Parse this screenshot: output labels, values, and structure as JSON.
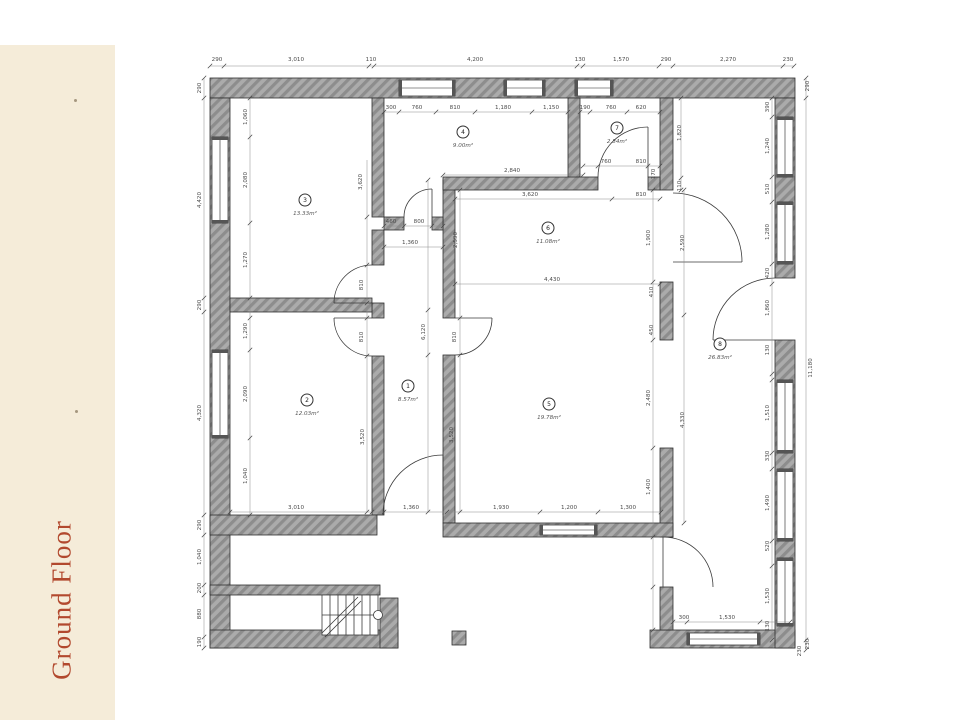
{
  "sidebar": {
    "title": "Ground Floor",
    "bg": "#f5ecd9",
    "text_color": "#b2492e"
  },
  "plan": {
    "wall_fill": "#ababab",
    "wall_hatch": "#8d8d8d",
    "line_color": "#3a3a3a",
    "dim_color": "#4a4a4a",
    "rooms": [
      {
        "number": "1",
        "area": "8.57m²",
        "x": 408,
        "y": 386
      },
      {
        "number": "2",
        "area": "12.03m²",
        "x": 307,
        "y": 400
      },
      {
        "number": "3",
        "area": "13.33m²",
        "x": 305,
        "y": 200
      },
      {
        "number": "4",
        "area": "9.00m²",
        "x": 463,
        "y": 132
      },
      {
        "number": "5",
        "area": "19.78m²",
        "x": 549,
        "y": 404
      },
      {
        "number": "6",
        "area": "11.08m²",
        "x": 548,
        "y": 228
      },
      {
        "number": "7",
        "area": "2.84m²",
        "x": 617,
        "y": 128
      },
      {
        "number": "8",
        "area": "26.83m²",
        "x": 720,
        "y": 344
      }
    ],
    "dimensions": [
      {
        "t": "290",
        "x": 217,
        "y": 61
      },
      {
        "t": "3,010",
        "x": 296,
        "y": 61
      },
      {
        "t": "110",
        "x": 371,
        "y": 61
      },
      {
        "t": "4,200",
        "x": 475,
        "y": 61
      },
      {
        "t": "130",
        "x": 580,
        "y": 61
      },
      {
        "t": "1,570",
        "x": 621,
        "y": 61
      },
      {
        "t": "290",
        "x": 666,
        "y": 61
      },
      {
        "t": "2,270",
        "x": 728,
        "y": 61
      },
      {
        "t": "230",
        "x": 788,
        "y": 61
      },
      {
        "t": "300",
        "x": 391,
        "y": 109
      },
      {
        "t": "760",
        "x": 417,
        "y": 109
      },
      {
        "t": "810",
        "x": 455,
        "y": 109
      },
      {
        "t": "1,180",
        "x": 503,
        "y": 109
      },
      {
        "t": "1,150",
        "x": 551,
        "y": 109
      },
      {
        "t": "190",
        "x": 585,
        "y": 109
      },
      {
        "t": "760",
        "x": 611,
        "y": 109
      },
      {
        "t": "620",
        "x": 641,
        "y": 109
      },
      {
        "t": "760",
        "x": 606,
        "y": 163
      },
      {
        "t": "810",
        "x": 641,
        "y": 163
      },
      {
        "t": "2,840",
        "x": 512,
        "y": 172
      },
      {
        "t": "3,620",
        "x": 530,
        "y": 196
      },
      {
        "t": "810",
        "x": 641,
        "y": 196
      },
      {
        "t": "4,430",
        "x": 552,
        "y": 281
      },
      {
        "t": "1,360",
        "x": 410,
        "y": 244
      },
      {
        "t": "460",
        "x": 391,
        "y": 223
      },
      {
        "t": "800",
        "x": 419,
        "y": 223
      },
      {
        "t": "3,010",
        "x": 296,
        "y": 509
      },
      {
        "t": "1,360",
        "x": 411,
        "y": 509
      },
      {
        "t": "1,930",
        "x": 501,
        "y": 509
      },
      {
        "t": "1,200",
        "x": 569,
        "y": 509
      },
      {
        "t": "1,300",
        "x": 628,
        "y": 509
      },
      {
        "t": "300",
        "x": 684,
        "y": 619
      },
      {
        "t": "1,530",
        "x": 727,
        "y": 619
      },
      {
        "t": "290",
        "x": 201,
        "y": 88,
        "r": 1
      },
      {
        "t": "4,420",
        "x": 201,
        "y": 200,
        "r": 1
      },
      {
        "t": "290",
        "x": 201,
        "y": 305,
        "r": 1
      },
      {
        "t": "4,320",
        "x": 201,
        "y": 413,
        "r": 1
      },
      {
        "t": "290",
        "x": 201,
        "y": 525,
        "r": 1
      },
      {
        "t": "1,040",
        "x": 201,
        "y": 557,
        "r": 1
      },
      {
        "t": "200",
        "x": 201,
        "y": 588,
        "r": 1
      },
      {
        "t": "880",
        "x": 201,
        "y": 614,
        "r": 1
      },
      {
        "t": "190",
        "x": 201,
        "y": 642,
        "r": 1
      },
      {
        "t": "1,060",
        "x": 247,
        "y": 117,
        "r": 1
      },
      {
        "t": "2,080",
        "x": 247,
        "y": 180,
        "r": 1
      },
      {
        "t": "1,270",
        "x": 247,
        "y": 260,
        "r": 1
      },
      {
        "t": "1,290",
        "x": 247,
        "y": 331,
        "r": 1
      },
      {
        "t": "2,090",
        "x": 247,
        "y": 394,
        "r": 1
      },
      {
        "t": "1,040",
        "x": 247,
        "y": 476,
        "r": 1
      },
      {
        "t": "3,620",
        "x": 362,
        "y": 182,
        "r": 1
      },
      {
        "t": "810",
        "x": 363,
        "y": 285,
        "r": 1
      },
      {
        "t": "810",
        "x": 363,
        "y": 337,
        "r": 1
      },
      {
        "t": "3,520",
        "x": 364,
        "y": 437,
        "r": 1
      },
      {
        "t": "6,120",
        "x": 425,
        "y": 332,
        "r": 1
      },
      {
        "t": "810",
        "x": 456,
        "y": 337,
        "r": 1
      },
      {
        "t": "2,590",
        "x": 457,
        "y": 240,
        "r": 1
      },
      {
        "t": "3,520",
        "x": 453,
        "y": 435,
        "r": 1
      },
      {
        "t": "170",
        "x": 655,
        "y": 174,
        "r": 1
      },
      {
        "t": "1,900",
        "x": 650,
        "y": 238,
        "r": 1
      },
      {
        "t": "410",
        "x": 653,
        "y": 292,
        "r": 1
      },
      {
        "t": "450",
        "x": 653,
        "y": 330,
        "r": 1
      },
      {
        "t": "2,480",
        "x": 650,
        "y": 398,
        "r": 1
      },
      {
        "t": "1,400",
        "x": 650,
        "y": 487,
        "r": 1
      },
      {
        "t": "1,820",
        "x": 681,
        "y": 133,
        "r": 1
      },
      {
        "t": "110",
        "x": 681,
        "y": 186,
        "r": 1
      },
      {
        "t": "2,590",
        "x": 684,
        "y": 243,
        "r": 1
      },
      {
        "t": "4,330",
        "x": 684,
        "y": 420,
        "r": 1
      },
      {
        "t": "290",
        "x": 809,
        "y": 86,
        "r": 1
      },
      {
        "t": "11,180",
        "x": 812,
        "y": 368,
        "r": 1
      },
      {
        "t": "230",
        "x": 809,
        "y": 644,
        "r": 1
      },
      {
        "t": "230",
        "x": 801,
        "y": 651,
        "r": 1
      },
      {
        "t": "390",
        "x": 769,
        "y": 107,
        "r": 1
      },
      {
        "t": "1,240",
        "x": 769,
        "y": 146,
        "r": 1
      },
      {
        "t": "510",
        "x": 769,
        "y": 189,
        "r": 1
      },
      {
        "t": "1,280",
        "x": 769,
        "y": 232,
        "r": 1
      },
      {
        "t": "420",
        "x": 769,
        "y": 273,
        "r": 1
      },
      {
        "t": "1,860",
        "x": 769,
        "y": 308,
        "r": 1
      },
      {
        "t": "130",
        "x": 769,
        "y": 350,
        "r": 1
      },
      {
        "t": "1,510",
        "x": 769,
        "y": 413,
        "r": 1
      },
      {
        "t": "330",
        "x": 769,
        "y": 456,
        "r": 1
      },
      {
        "t": "1,490",
        "x": 769,
        "y": 503,
        "r": 1
      },
      {
        "t": "520",
        "x": 769,
        "y": 546,
        "r": 1
      },
      {
        "t": "1,530",
        "x": 769,
        "y": 596,
        "r": 1
      },
      {
        "t": "130",
        "x": 769,
        "y": 626,
        "r": 1
      }
    ]
  }
}
